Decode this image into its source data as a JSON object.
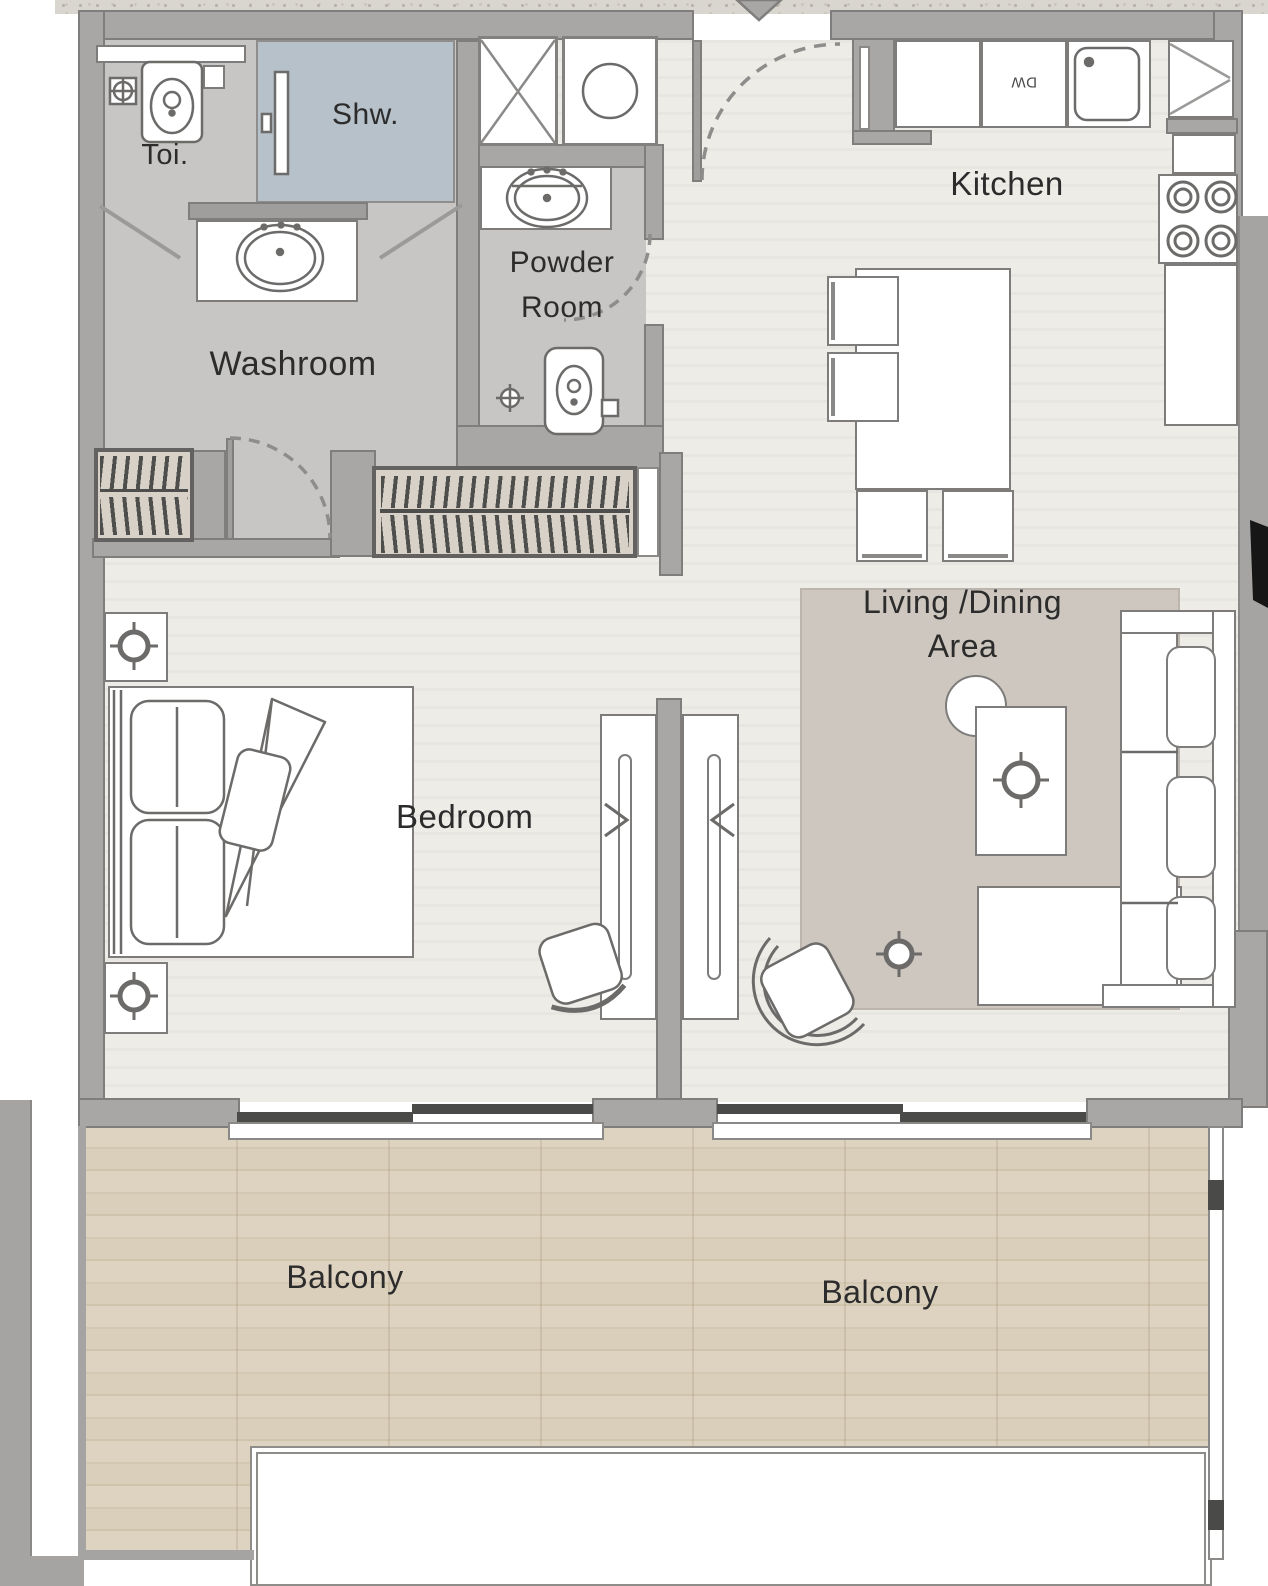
{
  "plan": {
    "rooms": {
      "washroom": {
        "label": "Washroom"
      },
      "toilet_nook": {
        "label": "Toi."
      },
      "shower": {
        "label": "Shw."
      },
      "powder_room": {
        "line1": "Powder",
        "line2": "Room"
      },
      "kitchen": {
        "label": "Kitchen"
      },
      "living_dining": {
        "line1": "Living /Dining",
        "line2": "Area"
      },
      "bedroom": {
        "label": "Bedroom"
      },
      "balcony_left": {
        "label": "Balcony"
      },
      "balcony_right": {
        "label": "Balcony"
      }
    },
    "appliances": {
      "dishwasher": "DW"
    },
    "colors": {
      "wall": "#a8a7a5",
      "wall_outline": "#7f7e7c",
      "wet_room_floor": "#c7c6c4",
      "shower_tile": "#b6c1c9",
      "closet_floor": "#d8d1c7",
      "main_floor": "#eeece7",
      "rug": "#cec7c0",
      "balcony_wood": "#dcd1be",
      "fixture_outline": "#6c6b69",
      "label_text": "#2c2c2c",
      "slider_bar": "#4a4a49"
    }
  }
}
